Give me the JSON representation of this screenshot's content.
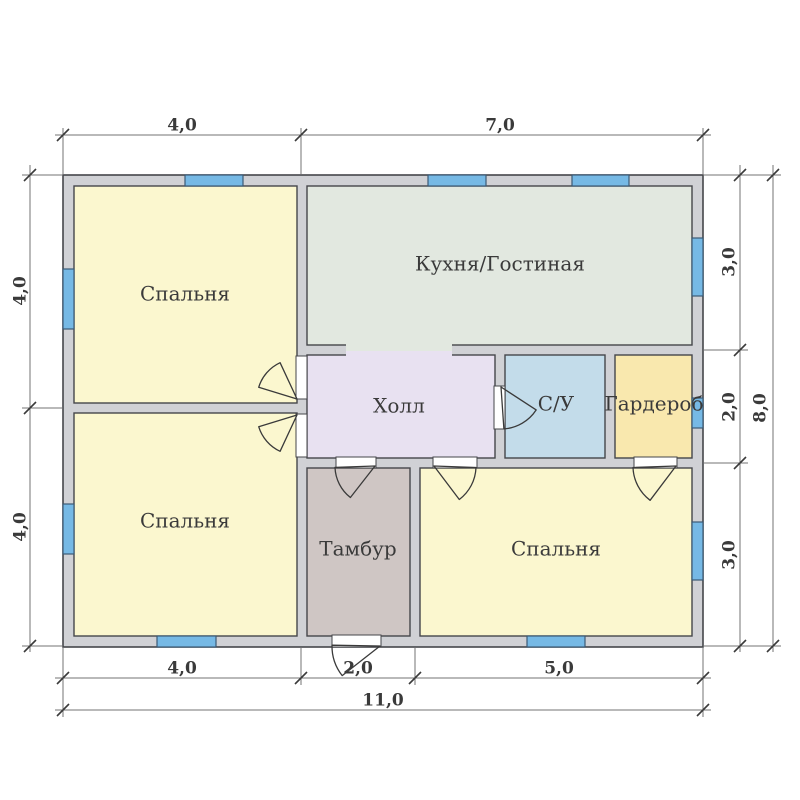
{
  "plan_title": "floor-plan",
  "palette": {
    "background": "#ffffff",
    "wall_fill": "#d0d1d5",
    "wall_line": "#45464a",
    "window_fill": "#76b9e5",
    "window_line": "#3c5a75",
    "opening_fill": "#ffffff",
    "dim_line": "#737373",
    "tick_line": "#3a3a3a",
    "text": "#3a3a3a"
  },
  "building": {
    "x": 63,
    "y": 175,
    "w": 640,
    "h": 472
  },
  "rooms": [
    {
      "id": "bedroom-tl",
      "label": "Спальня",
      "fill": "#fbf7cf",
      "x": 74,
      "y": 186,
      "w": 223,
      "h": 217,
      "label_cx": 185,
      "label_cy": 295,
      "font": 20
    },
    {
      "id": "kitchen-living",
      "label": "Кухня/Гостиная",
      "fill": "#e2e8e0",
      "x": 307,
      "y": 186,
      "w": 385,
      "h": 159,
      "label_cx": 500,
      "label_cy": 265,
      "font": 20
    },
    {
      "id": "hall",
      "label": "Холл",
      "fill": "#e8e1f1",
      "x": 307,
      "y": 355,
      "w": 188,
      "h": 103,
      "label_cx": 399,
      "label_cy": 407,
      "font": 20
    },
    {
      "id": "bathroom",
      "label": "С/У",
      "fill": "#c3dcea",
      "x": 505,
      "y": 355,
      "w": 100,
      "h": 103,
      "label_cx": 556,
      "label_cy": 405,
      "font": 20
    },
    {
      "id": "wardrobe",
      "label": "Гардероб",
      "fill": "#f9e8ae",
      "x": 615,
      "y": 355,
      "w": 77,
      "h": 103,
      "label_cx": 654,
      "label_cy": 405,
      "font": 17
    },
    {
      "id": "bedroom-bl",
      "label": "Спальня",
      "fill": "#fbf7cf",
      "x": 74,
      "y": 413,
      "w": 223,
      "h": 223,
      "label_cx": 185,
      "label_cy": 522,
      "font": 20
    },
    {
      "id": "tambour",
      "label": "Тамбур",
      "fill": "#cfc6c4",
      "x": 307,
      "y": 468,
      "w": 103,
      "h": 168,
      "label_cx": 358,
      "label_cy": 550,
      "font": 20
    },
    {
      "id": "bedroom-br",
      "label": "Спальня",
      "fill": "#fbf7cf",
      "x": 420,
      "y": 468,
      "w": 272,
      "h": 168,
      "label_cx": 556,
      "label_cy": 550,
      "font": 20
    }
  ],
  "passage": {
    "x": 346,
    "y": 343,
    "w": 106,
    "split": 351,
    "bottom": 357,
    "top_fill": "#e2e8e0",
    "bottom_fill": "#e8e1f1"
  },
  "windows": [
    {
      "x": 185,
      "y": 175,
      "w": 58,
      "h": 11
    },
    {
      "x": 428,
      "y": 175,
      "w": 58,
      "h": 11
    },
    {
      "x": 572,
      "y": 175,
      "w": 57,
      "h": 11
    },
    {
      "x": 63,
      "y": 269,
      "w": 11,
      "h": 60
    },
    {
      "x": 63,
      "y": 504,
      "w": 11,
      "h": 50
    },
    {
      "x": 692,
      "y": 238,
      "w": 11,
      "h": 58
    },
    {
      "x": 692,
      "y": 398,
      "w": 11,
      "h": 30
    },
    {
      "x": 692,
      "y": 522,
      "w": 11,
      "h": 58
    },
    {
      "x": 157,
      "y": 636,
      "w": 59,
      "h": 11
    },
    {
      "x": 527,
      "y": 636,
      "w": 58,
      "h": 11
    }
  ],
  "openings": [
    {
      "x": 296,
      "y": 356,
      "w": 11,
      "h": 43
    },
    {
      "x": 296,
      "y": 414,
      "w": 11,
      "h": 43
    },
    {
      "x": 494,
      "y": 386,
      "w": 11,
      "h": 43
    },
    {
      "x": 336,
      "y": 457,
      "w": 40,
      "h": 11
    },
    {
      "x": 433,
      "y": 457,
      "w": 44,
      "h": 11
    },
    {
      "x": 634,
      "y": 457,
      "w": 43,
      "h": 11
    },
    {
      "x": 332,
      "y": 635,
      "w": 49,
      "h": 12
    }
  ],
  "doors": [
    {
      "id": "door-bedroom-tl",
      "hinge": [
        297,
        399
      ],
      "r": 40,
      "a1": 245,
      "a2": 197
    },
    {
      "id": "door-bedroom-bl",
      "hinge": [
        297,
        415
      ],
      "r": 40,
      "a1": 115,
      "a2": 163
    },
    {
      "id": "door-bathroom",
      "hinge": [
        501,
        387
      ],
      "r": 42,
      "a1": 33,
      "a2": 86
    },
    {
      "id": "door-tambour",
      "hinge": [
        375,
        466
      ],
      "r": 40,
      "a1": 178,
      "a2": 128
    },
    {
      "id": "door-bedroom-br",
      "hinge": [
        434,
        466
      ],
      "r": 42,
      "a1": 2,
      "a2": 53
    },
    {
      "id": "door-wardrobe",
      "hinge": [
        676,
        466
      ],
      "r": 43,
      "a1": 178,
      "a2": 127
    },
    {
      "id": "door-entrance",
      "hinge": [
        380,
        646
      ],
      "r": 48,
      "a1": 181,
      "a2": 142
    }
  ],
  "dimensions": {
    "horizontal": [
      {
        "name": "top",
        "y": 135,
        "x1": 55,
        "x2": 711,
        "ticks": [
          63,
          301,
          703
        ],
        "labels": [
          {
            "text": "4,0",
            "cx": 182,
            "cy": 126
          },
          {
            "text": "7,0",
            "cx": 500,
            "cy": 126
          }
        ],
        "ext": [
          {
            "x": 63,
            "y1": 128,
            "y2": 174
          },
          {
            "x": 301,
            "y1": 128,
            "y2": 174
          },
          {
            "x": 703,
            "y1": 128,
            "y2": 174
          }
        ]
      },
      {
        "name": "bottom-inner",
        "y": 678,
        "x1": 55,
        "x2": 711,
        "ticks": [
          63,
          301,
          415,
          703
        ],
        "labels": [
          {
            "text": "4,0",
            "cx": 182,
            "cy": 669
          },
          {
            "text": "2,0",
            "cx": 358,
            "cy": 669
          },
          {
            "text": "5,0",
            "cx": 559,
            "cy": 669
          }
        ],
        "ext": [
          {
            "x": 63,
            "y1": 648,
            "y2": 717
          },
          {
            "x": 301,
            "y1": 648,
            "y2": 685
          },
          {
            "x": 415,
            "y1": 648,
            "y2": 685
          },
          {
            "x": 703,
            "y1": 648,
            "y2": 717
          }
        ]
      },
      {
        "name": "bottom-outer",
        "y": 710,
        "x1": 55,
        "x2": 711,
        "ticks": [
          63,
          703
        ],
        "labels": [
          {
            "text": "11,0",
            "cx": 383,
            "cy": 701
          }
        ],
        "ext": []
      }
    ],
    "vertical": [
      {
        "name": "left",
        "x": 30,
        "y1": 165,
        "y2": 652,
        "ticks": [
          175,
          408,
          646
        ],
        "labels": [
          {
            "text": "4,0",
            "cx": 21,
            "cy": 291
          },
          {
            "text": "4,0",
            "cx": 21,
            "cy": 527
          }
        ],
        "ext": [
          {
            "y": 175,
            "x1": 22,
            "x2": 62
          },
          {
            "y": 408,
            "x1": 22,
            "x2": 62
          },
          {
            "y": 646,
            "x1": 22,
            "x2": 62
          }
        ]
      },
      {
        "name": "right-inner",
        "x": 740,
        "y1": 165,
        "y2": 652,
        "ticks": [
          175,
          350,
          463,
          646
        ],
        "labels": [
          {
            "text": "3,0",
            "cx": 730,
            "cy": 262
          },
          {
            "text": "2,0",
            "cx": 730,
            "cy": 407
          },
          {
            "text": "3,0",
            "cx": 730,
            "cy": 555
          }
        ],
        "ext": [
          {
            "y": 175,
            "x1": 704,
            "x2": 781
          },
          {
            "y": 350,
            "x1": 704,
            "x2": 748
          },
          {
            "y": 463,
            "x1": 704,
            "x2": 748
          },
          {
            "y": 646,
            "x1": 704,
            "x2": 781
          }
        ]
      },
      {
        "name": "right-outer",
        "x": 773,
        "y1": 165,
        "y2": 652,
        "ticks": [
          175,
          646
        ],
        "labels": [
          {
            "text": "8,0",
            "cx": 761,
            "cy": 408
          }
        ],
        "ext": []
      }
    ]
  }
}
